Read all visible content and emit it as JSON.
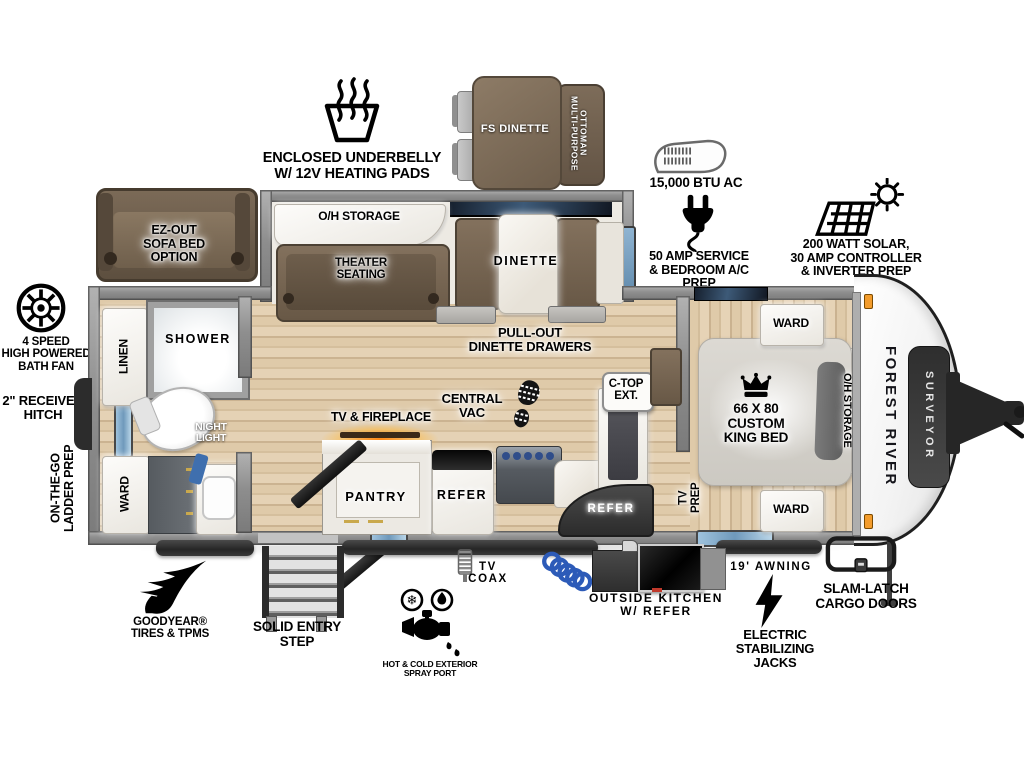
{
  "callouts": {
    "underbelly": "ENCLOSED UNDERBELLY\nW/ 12V HEATING PADS",
    "fs_dinette": "FS DINETTE",
    "ottoman": "MULTI-PURPOSE\nOTTOMAN",
    "btu_ac": "15,000 BTU AC",
    "amp_service": "50 AMP SERVICE\n& BEDROOM A/C PREP",
    "solar": "200 WATT SOLAR,\n30 AMP CONTROLLER\n& INVERTER PREP",
    "sofa_option": "EZ-OUT\nSOFA BED\nOPTION",
    "bath_fan": "4 SPEED\nHIGH POWERED\nBATH FAN",
    "receiver_hitch": "2\" RECEIVER\nHITCH",
    "ladder_prep": "ON-THE-GO\nLADDER PREP",
    "goodyear": "GOODYEAR®\nTIRES & TPMS",
    "entry_step": "SOLID ENTRY\nSTEP",
    "spray_port": "HOT & COLD EXTERIOR\nSPRAY PORT",
    "tv_coax": "TV\nCOAX",
    "outside_kitchen": "OUTSIDE KITCHEN\nW/ REFER",
    "awning": "19' AWNING",
    "stab_jacks": "ELECTRIC\nSTABILIZING\nJACKS",
    "cargo_doors": "SLAM-LATCH\nCARGO DOORS"
  },
  "rooms": {
    "oh_storage": "O/H STORAGE",
    "theater": "THEATER\nSEATING",
    "dinette": "DINETTE",
    "pullout_drawers": "PULL-OUT\nDINETTE DRAWERS",
    "central_vac": "CENTRAL\nVAC",
    "ctop_ext": "C-TOP\nEXT.",
    "tv_fireplace": "TV & FIREPLACE",
    "pantry": "PANTRY",
    "refer": "REFER",
    "outside_refer": "REFER",
    "linen": "LINEN",
    "shower": "SHOWER",
    "night_light": "NIGHT\nLIGHT",
    "ward": "WARD",
    "ward_top": "WARD",
    "ward_bottom": "WARD",
    "king_bed": "66 X 80\nCUSTOM\nKING BED",
    "bed_oh_storage": "O/H STORAGE",
    "tv_prep": "TV\nPREP"
  },
  "branding": {
    "make": "FOREST RIVER",
    "model": "SURVEYOR"
  },
  "colors": {
    "floor": "#d9c3a3",
    "wall": "#8e8e8e",
    "furniture": "#75634f",
    "fireplace_glow": "#ff9020",
    "window_blue": "#7ea7c9",
    "marker_light": "#f39c2c"
  }
}
